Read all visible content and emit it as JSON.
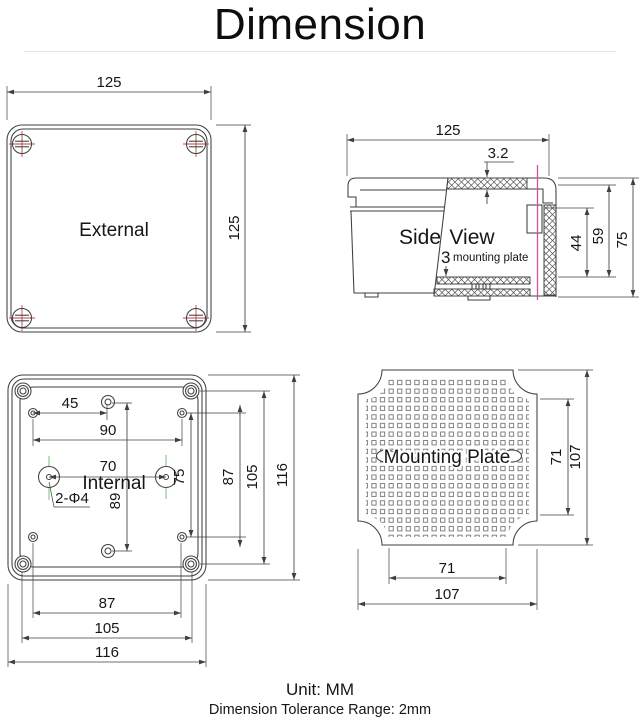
{
  "title": "Dimension",
  "footer": {
    "unit": "Unit: MM",
    "tolerance": "Dimension Tolerance Range: 2mm"
  },
  "colors": {
    "line-color": "#3f3f3f",
    "text-color": "#161616",
    "red-color": "#b54545",
    "green-color": "#8fca8f",
    "magenta-color": "#c855a3"
  },
  "views": {
    "external": {
      "label": "External",
      "dim_width": "125",
      "dim_height": "125"
    },
    "side": {
      "label_word1": "Side",
      "label_word2": "View",
      "dim_width": "125",
      "dim_lid_thickness": "3.2",
      "dim_depth_inner": "44",
      "dim_depth_cavity": "59",
      "dim_height": "75",
      "callout_number": "3",
      "callout_text": "mounting plate"
    },
    "internal": {
      "label": "Internal",
      "hole_callout": "2-Φ4",
      "dim_hole_offset": "45",
      "dim_hole_span": "90",
      "dim_boss_span": "70",
      "dim_center_holes": "89",
      "dim_side_holes": "75",
      "dim_v_holes": "87",
      "dim_v_bosses": "105",
      "dim_v_overall": "116",
      "dim_h_holes": "87",
      "dim_h_bosses": "105",
      "dim_h_overall": "116"
    },
    "plate": {
      "label": "Mounting Plate",
      "dim_v_slots": "71",
      "dim_v_overall": "107",
      "dim_h_slots": "71",
      "dim_h_overall": "107"
    }
  }
}
